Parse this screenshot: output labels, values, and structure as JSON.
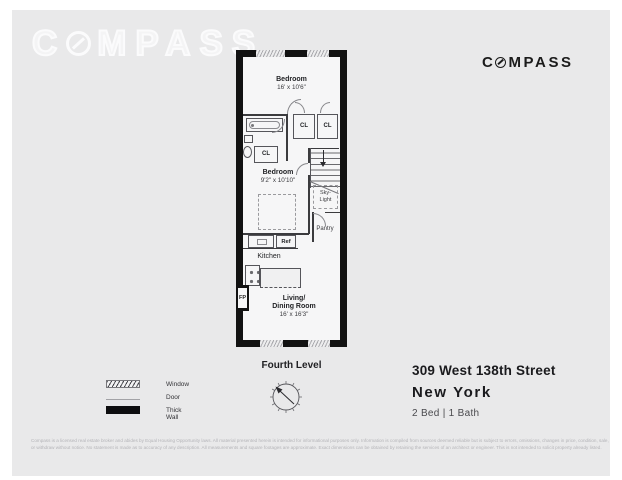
{
  "brand": {
    "pre": "C",
    "post": "MPASS",
    "full": "COMPASS"
  },
  "watermark": {
    "pre": "C",
    "post": "MPASS",
    "full": "COMPASS"
  },
  "floorplan": {
    "level_label": "Fourth Level",
    "rooms": {
      "bedroom1": {
        "name": "Bedroom",
        "dims": "16' x 10'6\""
      },
      "bedroom2": {
        "name": "Bedroom",
        "dims": "9'2\" x 10'10\""
      },
      "kitchen": {
        "name": "Kitchen"
      },
      "living": {
        "line1": "Living/",
        "line2": "Dining Room",
        "dims": "16' x 16'3\""
      },
      "pantry": {
        "name": "Pantry"
      },
      "skylight": {
        "line1": "Sky-",
        "line2": "Light"
      }
    },
    "labels": {
      "closet": "CL",
      "ref": "Ref",
      "fireplace": "FP"
    }
  },
  "legend": {
    "items": [
      {
        "label": "Window"
      },
      {
        "label": "Door"
      },
      {
        "label": "Thick Wall"
      }
    ]
  },
  "listing": {
    "address": "309 West 138th Street",
    "city": "New York",
    "beds_baths": "2 Bed | 1 Bath"
  },
  "disclaimer": {
    "line1": "Compass is a licensed real estate broker and abides by Equal Housing Opportunity laws. All material presented herein is intended for informational purposes only. Information is compiled from sources deemed reliable but is subject to errors, omissions, changes in price, condition, sale,",
    "line2": "or withdraw without notice. No statement is made as to accuracy of any description. All measurements and square footages are approximate. Exact dimensions can be obtained by retaining the services of an architect or engineer. This is not intended to solicit property already listed."
  },
  "colors": {
    "canvas": "#e9e9ea",
    "wall": "#121212",
    "brand_text": "#1b1b1b"
  }
}
